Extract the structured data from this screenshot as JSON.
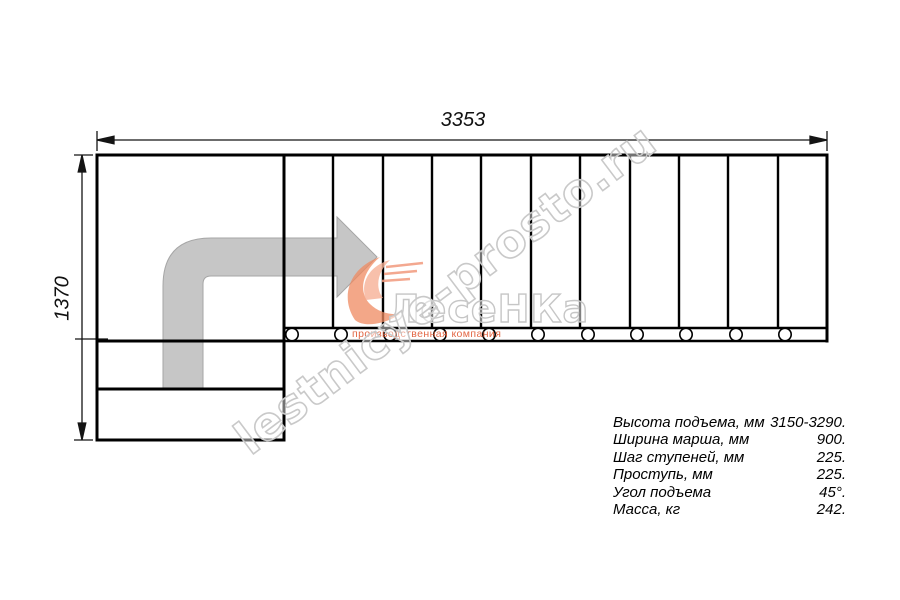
{
  "drawing": {
    "title": "stair-plan-top-view",
    "width_label": "3353",
    "height_label": "1370",
    "step_count": 11
  },
  "watermark": {
    "site_text": "lestnicye-prosto.ru",
    "logo_title": "ЛесеНКа",
    "logo_subtitle": "производственная компания",
    "outline_color": "#cacaca",
    "logo_orange": "#f0906c",
    "subtitle_color": "#e05a35"
  },
  "specs": {
    "rows": [
      {
        "label": "Высота подъема, мм",
        "value": "3150-3290."
      },
      {
        "label": "Ширина марша, мм",
        "value": "900."
      },
      {
        "label": "Шаг ступеней, мм",
        "value": "225."
      },
      {
        "label": "Проступь, мм",
        "value": "225."
      },
      {
        "label": "Угол подъема",
        "value": "45°."
      },
      {
        "label": "Масса, кг",
        "value": "242."
      }
    ]
  },
  "colors": {
    "line": "#000000",
    "dimension": "#141414",
    "arrow_fill": "#c6c6c6",
    "arrow_edge": "#a6a6a6"
  }
}
